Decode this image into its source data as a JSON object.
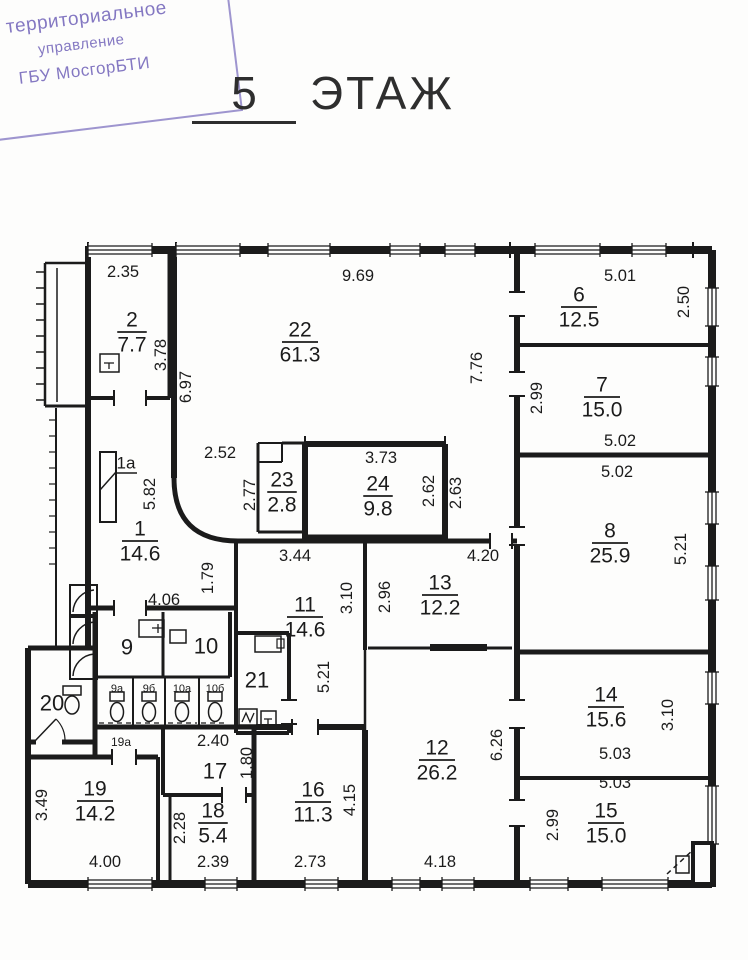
{
  "stamp": {
    "line1": "е территориальное",
    "line2": "управление",
    "line3": "ГБУ МосгорБТИ",
    "ink_color": "#8478c2"
  },
  "title": {
    "number": "5",
    "word": "ЭТАЖ"
  },
  "plan": {
    "line_color": "#1b1b1b",
    "rooms": [
      {
        "num": "2",
        "area": "7.7",
        "x": 132,
        "y": 332
      },
      {
        "num": "22",
        "area": "61.3",
        "x": 300,
        "y": 342
      },
      {
        "num": "6",
        "area": "12.5",
        "x": 579,
        "y": 307
      },
      {
        "num": "7",
        "area": "15.0",
        "x": 602,
        "y": 397
      },
      {
        "num": "8",
        "area": "25.9",
        "x": 610,
        "y": 543
      },
      {
        "num": "1",
        "area": "14.6",
        "x": 140,
        "y": 541
      },
      {
        "num": "23",
        "area": "2.8",
        "x": 282,
        "y": 492
      },
      {
        "num": "24",
        "area": "9.8",
        "x": 378,
        "y": 496
      },
      {
        "num": "11",
        "area": "14.6",
        "x": 305,
        "y": 617
      },
      {
        "num": "13",
        "area": "12.2",
        "x": 440,
        "y": 595
      },
      {
        "num": "12",
        "area": "26.2",
        "x": 437,
        "y": 760
      },
      {
        "num": "14",
        "area": "15.6",
        "x": 606,
        "y": 707
      },
      {
        "num": "15",
        "area": "15.0",
        "x": 606,
        "y": 823
      },
      {
        "num": "16",
        "area": "11.3",
        "x": 313,
        "y": 802
      },
      {
        "num": "18",
        "area": "5.4",
        "x": 213,
        "y": 823
      },
      {
        "num": "19",
        "area": "14.2",
        "x": 95,
        "y": 801
      }
    ],
    "labels": [
      {
        "text": "1a",
        "x": 126,
        "y": 463,
        "size": 17,
        "underline": true
      },
      {
        "text": "9",
        "x": 127,
        "y": 647,
        "size": 22
      },
      {
        "text": "10",
        "x": 206,
        "y": 646,
        "size": 22
      },
      {
        "text": "20",
        "x": 52,
        "y": 703,
        "size": 22
      },
      {
        "text": "21",
        "x": 257,
        "y": 680,
        "size": 22
      },
      {
        "text": "17",
        "x": 215,
        "y": 771,
        "size": 22
      },
      {
        "text": "9а",
        "x": 117,
        "y": 689,
        "size": 11
      },
      {
        "text": "9б",
        "x": 149,
        "y": 689,
        "size": 11
      },
      {
        "text": "10а",
        "x": 182,
        "y": 689,
        "size": 11
      },
      {
        "text": "10б",
        "x": 215,
        "y": 689,
        "size": 11
      },
      {
        "text": "19а",
        "x": 121,
        "y": 742,
        "size": 12
      }
    ],
    "dims": [
      {
        "text": "2.35",
        "x": 123,
        "y": 272,
        "rot": 0
      },
      {
        "text": "9.69",
        "x": 358,
        "y": 276,
        "rot": 0
      },
      {
        "text": "5.01",
        "x": 620,
        "y": 276,
        "rot": 0
      },
      {
        "text": "2.50",
        "x": 684,
        "y": 302,
        "rot": -90
      },
      {
        "text": "3.78",
        "x": 161,
        "y": 355,
        "rot": -90
      },
      {
        "text": "6.97",
        "x": 186,
        "y": 387,
        "rot": -90
      },
      {
        "text": "7.76",
        "x": 477,
        "y": 368,
        "rot": -90
      },
      {
        "text": "2.99",
        "x": 537,
        "y": 398,
        "rot": -90
      },
      {
        "text": "2.52",
        "x": 220,
        "y": 453,
        "rot": 0
      },
      {
        "text": "5.02",
        "x": 620,
        "y": 441,
        "rot": 0
      },
      {
        "text": "3.73",
        "x": 381,
        "y": 458,
        "rot": 0
      },
      {
        "text": "5.02",
        "x": 617,
        "y": 472,
        "rot": 0
      },
      {
        "text": "2.77",
        "x": 250,
        "y": 495,
        "rot": -90
      },
      {
        "text": "2.62",
        "x": 429,
        "y": 491,
        "rot": -90
      },
      {
        "text": "2.63",
        "x": 456,
        "y": 493,
        "rot": -90
      },
      {
        "text": "5.82",
        "x": 150,
        "y": 494,
        "rot": -90
      },
      {
        "text": "5.21",
        "x": 681,
        "y": 549,
        "rot": -90
      },
      {
        "text": "3.44",
        "x": 295,
        "y": 556,
        "rot": 0
      },
      {
        "text": "4.20",
        "x": 483,
        "y": 556,
        "rot": 0
      },
      {
        "text": "1.79",
        "x": 208,
        "y": 578,
        "rot": -90
      },
      {
        "text": "2.96",
        "x": 385,
        "y": 597,
        "rot": -90
      },
      {
        "text": "3.10",
        "x": 347,
        "y": 598,
        "rot": -90
      },
      {
        "text": "4.06",
        "x": 164,
        "y": 600,
        "rot": 0
      },
      {
        "text": "5.21",
        "x": 324,
        "y": 677,
        "rot": -90
      },
      {
        "text": "6.26",
        "x": 497,
        "y": 745,
        "rot": -90
      },
      {
        "text": "3.10",
        "x": 668,
        "y": 715,
        "rot": -90
      },
      {
        "text": "2.40",
        "x": 213,
        "y": 741,
        "rot": 0
      },
      {
        "text": "1.80",
        "x": 247,
        "y": 763,
        "rot": -90
      },
      {
        "text": "5.03",
        "x": 615,
        "y": 754,
        "rot": 0
      },
      {
        "text": "5.03",
        "x": 615,
        "y": 783,
        "rot": 0
      },
      {
        "text": "3.49",
        "x": 42,
        "y": 805,
        "rot": -90
      },
      {
        "text": "4.15",
        "x": 350,
        "y": 800,
        "rot": -90
      },
      {
        "text": "2.99",
        "x": 553,
        "y": 825,
        "rot": -90
      },
      {
        "text": "2.28",
        "x": 180,
        "y": 828,
        "rot": -90
      },
      {
        "text": "2.39",
        "x": 213,
        "y": 862,
        "rot": 0
      },
      {
        "text": "2.73",
        "x": 310,
        "y": 862,
        "rot": 0
      },
      {
        "text": "4.00",
        "x": 105,
        "y": 862,
        "rot": 0
      },
      {
        "text": "4.18",
        "x": 440,
        "y": 862,
        "rot": 0
      }
    ]
  }
}
